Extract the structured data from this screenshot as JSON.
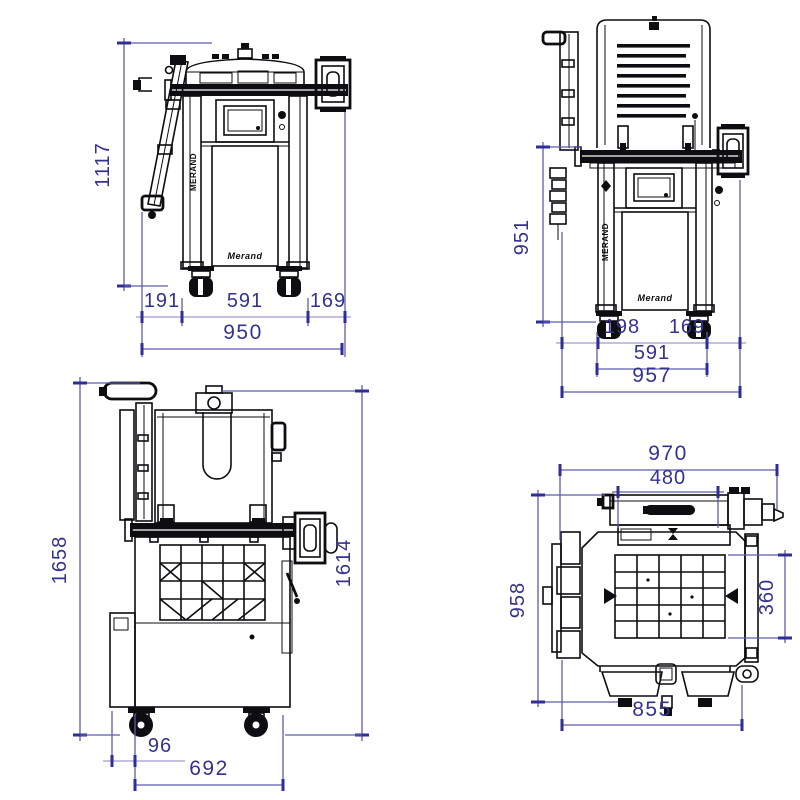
{
  "brand": {
    "pillar_text": "MERAND",
    "door_logo": "Merand"
  },
  "colors": {
    "dim_line": "#5c5cab",
    "dim_tick": "#2e2e96",
    "dim_text": "#33338f",
    "ink": "#0d0d12",
    "background": "#ffffff"
  },
  "views": {
    "front_closed": {
      "overall_height": "1117",
      "left_offset": "191",
      "wheel_track": "591",
      "right_offset": "169",
      "overall_width": "950"
    },
    "front_open": {
      "working_height": "951",
      "left_offset": "198",
      "right_offset": "169",
      "wheel_track": "591",
      "overall_width": "957"
    },
    "side_open": {
      "overall_height_open": "1658",
      "height_rear": "1614",
      "front_offset": "96",
      "depth": "692"
    },
    "top": {
      "overall_width": "970",
      "crossbar_width": "480",
      "overall_depth": "958",
      "grid_depth": "360",
      "base_width": "855"
    }
  }
}
